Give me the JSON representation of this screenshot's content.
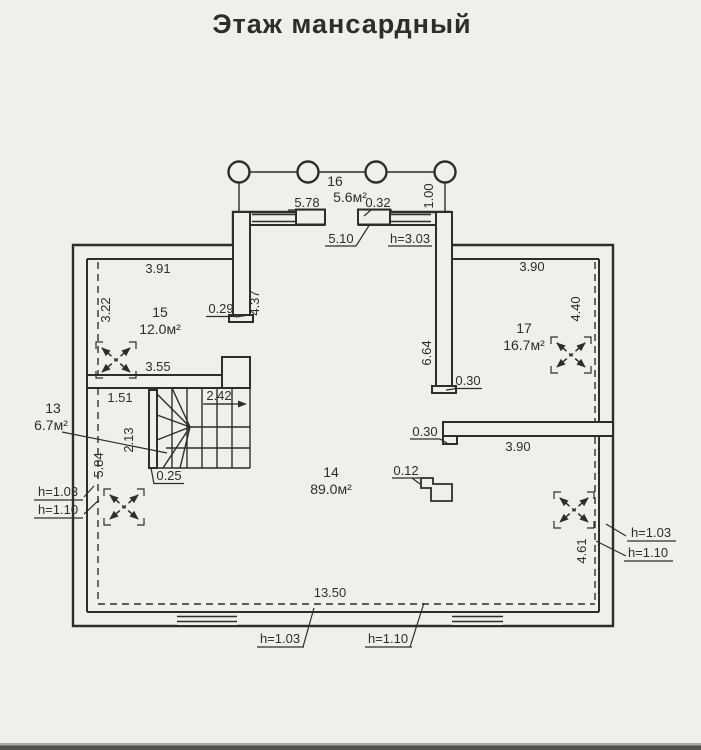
{
  "title": "Этаж мансардный",
  "colors": {
    "ink": "#2f2d2a",
    "paper": "#f1efeb"
  },
  "rooms": {
    "r13": {
      "number": "13",
      "area": "6.7м²"
    },
    "r14": {
      "number": "14",
      "area": "89.0м²"
    },
    "r15": {
      "number": "15",
      "area": "12.0м²"
    },
    "r16": {
      "number": "16",
      "area": "5.6м²"
    },
    "r17": {
      "number": "17",
      "area": "16.7м²"
    }
  },
  "dims": {
    "d578": "5.78",
    "d032": "0.32",
    "d100": "1.00",
    "d510": "5.10",
    "d391": "3.91",
    "d322": "3.22",
    "d029": "0.29",
    "d437": "4.37",
    "d355": "3.55",
    "d151": "1.51",
    "d213": "2.13",
    "d242": "2.42",
    "d025": "0.25",
    "d584": "5.84",
    "d664": "6.64",
    "d030_wall17": "0.30",
    "d030_wall14": "0.30",
    "d012": "0.12",
    "d390_top": "3.90",
    "d440": "4.40",
    "d390_bottom": "3.90",
    "d461": "4.61",
    "d1350": "13.50"
  },
  "heights": {
    "h303": "h=3.03",
    "left": {
      "h103": "h=1.03",
      "h110": "h=1.10"
    },
    "right": {
      "h103": "h=1.03",
      "h110": "h=1.10"
    },
    "bottom": {
      "h103": "h=1.03",
      "h110": "h=1.10"
    }
  }
}
